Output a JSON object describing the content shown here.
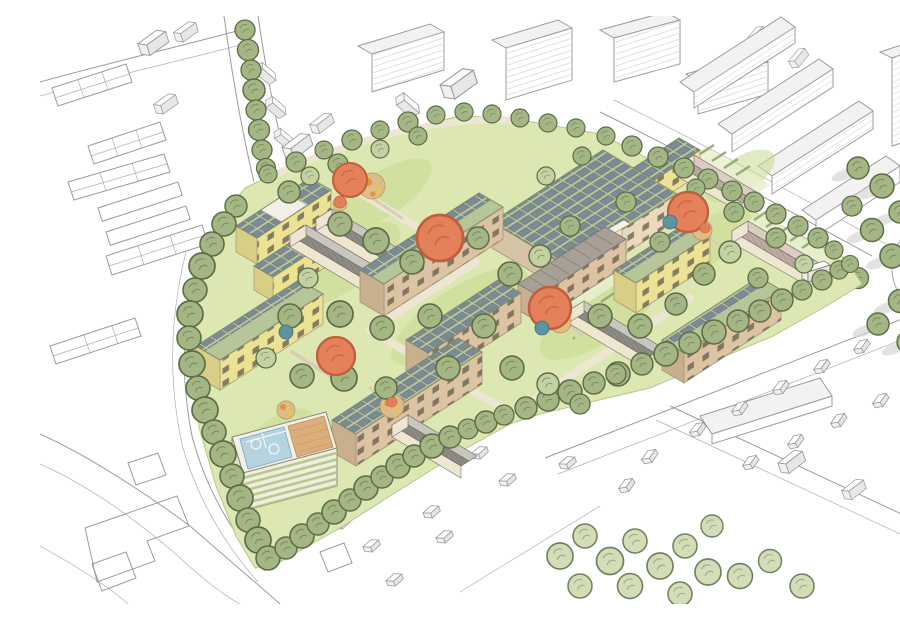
{
  "scene": {
    "type": "architectural-aerial-masterplan-illustration",
    "description": "Hand-drawn bird's-eye masterplan of a residential neighbourhood: apartment blocks with green roofs and solar panels, pitched-roof rowhouses, courtyard gardens with orange accent trees and play areas, a parking garage with rooftop sports courts and sand field, ringed by perimeter trees and white sketch-style context buildings, roads and parked cars.",
    "site": {
      "apartment_blocks_with_solar_green_roofs": 10,
      "pitched_roof_rowhouse_rows": 6,
      "terrace_row_with_mono_pitch_roof": 1,
      "parking_garage_with_rooftop_sports_deck": 1,
      "rooftop_courts": 2,
      "rooftop_sand_field": 1,
      "accent_trees_orange": 5,
      "accent_trees_teal": 3,
      "play_areas": 5,
      "perimeter_tree_ring": true
    },
    "context": {
      "style": "white line-drawn sketch buildings",
      "street_tree_avenue_top_left": true,
      "slab_building_rows_top_right": 4,
      "roundabout_right_edge": true,
      "parked_cars": true,
      "woodland_patch_bottom": true
    }
  },
  "palette": {
    "paper": "#ffffff",
    "ink": "#9b9b9b",
    "inkDark": "#6f6f6f",
    "ctxFace": "#f2f2f1",
    "ctxSide": "#e2e2e1",
    "shadow": "#d6d6d5",
    "site": "#dce7b2",
    "lawn": "#c9da90",
    "lawnLight": "#e9efcf",
    "treeFill": "#a3b684",
    "treeLight": "#c2d2a2",
    "treeStroke": "#5c6c45",
    "treeWash": "#ccd9ad",
    "washStroke": "#a3b386",
    "orange": "#e5815a",
    "orangeStroke": "#bf5f3d",
    "teal": "#5f93a0",
    "roofGreen": "#b7c698",
    "solar": "#7c8a96",
    "solarDark": "#66747f",
    "facadeYellow": "#ece294",
    "facadeYellowSide": "#d9ce85",
    "facadeCream": "#e9dabd",
    "facadeCreamSide": "#d4c3a4",
    "facadeTan": "#dcc3a2",
    "facadeTanSide": "#c8b08f",
    "windowDark": "#6b6354",
    "roofDark": "#8e8a84",
    "roofLight": "#c9c5bf",
    "roofPinkDark": "#c0aba1",
    "roofPinkLight": "#dcccc2",
    "gableCream": "#efe6cf",
    "path": "#d9cdb4",
    "pathLight": "#ece6d2",
    "poolBlue": "#b5d4e0",
    "poolLine": "#ffffff",
    "sand": "#dcae7c",
    "sandLine": "#c89a64",
    "deckWhite": "#f2efe6",
    "band": "#b9c48e",
    "garageSide": "#dfe2c8",
    "play": "#dcbd8a",
    "playDot": "#e2913f",
    "playYellow": "#e7c35b",
    "hedge": "#8fa56e"
  }
}
